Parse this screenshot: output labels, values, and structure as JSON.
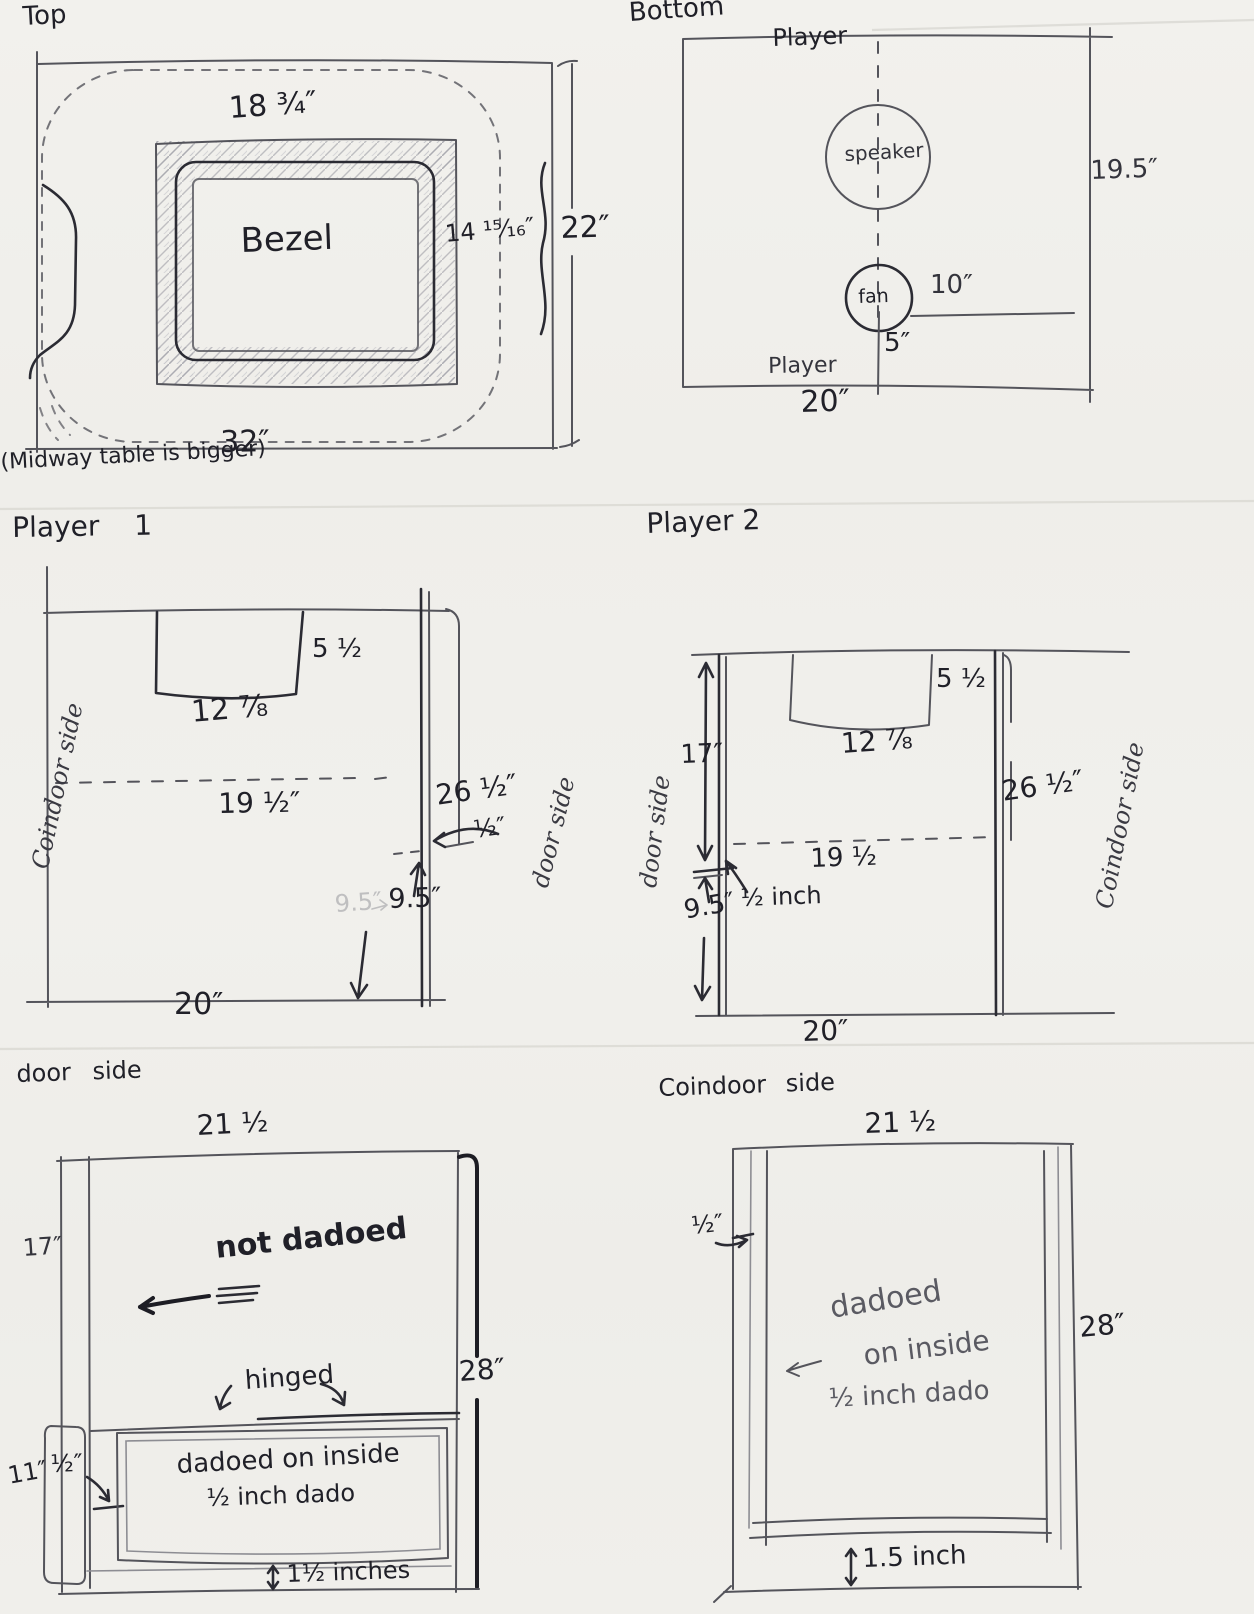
{
  "panels": {
    "top": {
      "title": "Top",
      "bezel_label": "Bezel",
      "bezel_width": "18 ¾″",
      "bezel_height": "14 ¹⁵⁄₁₆″",
      "overall_height": "22″",
      "overall_width": "32″",
      "note": "(Midway table is bigger)"
    },
    "bottom": {
      "title": "Bottom",
      "player_top": "Player",
      "player_bottom": "Player",
      "speaker_label": "speaker",
      "fan_label": "fan",
      "fan_offset": "10″",
      "fan_bottom": "5″",
      "panel_height": "19.5″",
      "panel_width": "20″"
    },
    "player1": {
      "title": "Player 1",
      "left_side_label": "Coindoor side",
      "right_side_label": "door side",
      "notch_depth": "5 ½",
      "notch_width": "12 ⅞",
      "dashed_width": "19 ½″",
      "panel_height": "26 ½″",
      "step_width": "½″",
      "step_height_faint": "9.5″",
      "step_height": "9.5″",
      "panel_width": "20″"
    },
    "player2": {
      "title": "Player 2",
      "left_side_label": "door side",
      "right_side_label": "Coindoor side",
      "top_to_step": "17″",
      "notch_depth": "5 ½",
      "notch_width": "12 ⅞",
      "dashed_width": "19 ½",
      "step_width": "½ inch",
      "step_height": "9.5″",
      "panel_height": "26 ½″",
      "panel_width": "20″"
    },
    "doorside": {
      "title": "door side",
      "top_width": "21 ½",
      "upper_height": "17″",
      "note_not_dadoed": "not dadoed",
      "note_hinged": "hinged",
      "panel_height": "28″",
      "board_height": "11″",
      "dado_offset": "½″",
      "note_dado_line1": "dadoed on inside",
      "note_dado_line2": "½ inch dado",
      "bottom_gap": "1½ inches"
    },
    "coindoor": {
      "title": "Coindoor side",
      "top_width": "21 ½",
      "dado_offset": "½″",
      "note_dado_line1": "dadoed",
      "note_dado_line2": "on inside",
      "note_dado_line3": "½ inch dado",
      "panel_height": "28″",
      "bottom_gap": "1.5 inch"
    }
  }
}
